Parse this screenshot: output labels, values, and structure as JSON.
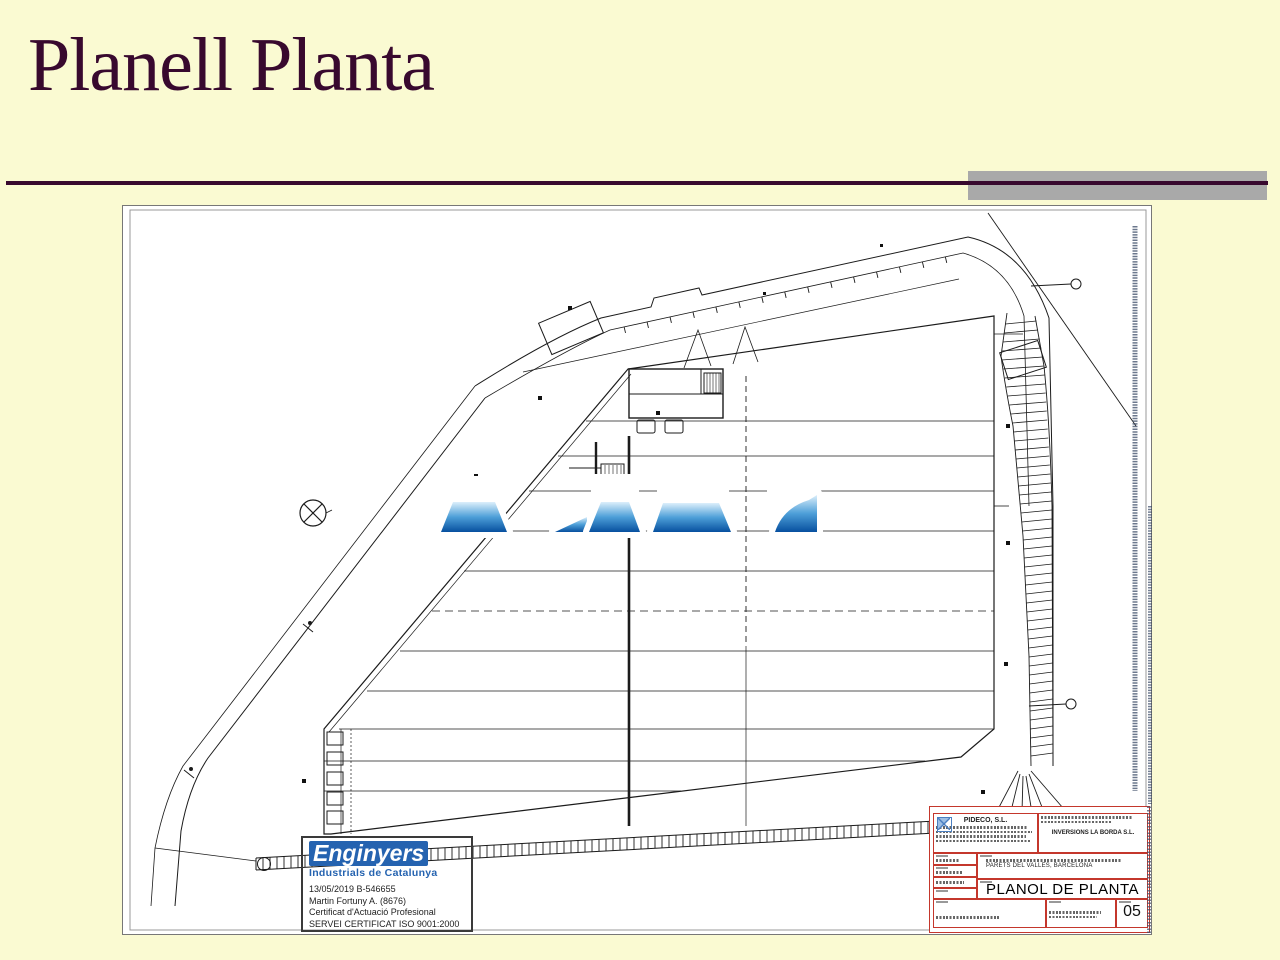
{
  "slide": {
    "title": "Planell Planta"
  },
  "colors": {
    "background": "#FAFAD2",
    "title_text": "#38092E",
    "divider": "#38092E",
    "accent_bar": "#A9A9A9",
    "stamp_blue": "#2563B0",
    "title_block_red": "#C4372C",
    "watermark_blue_dark": "#07509F",
    "watermark_blue_light": "#DCEFFB"
  },
  "plan": {
    "stamp": {
      "org": "Enginyers",
      "org_sub": "Industrials de Catalunya",
      "lines": [
        "13/05/2019   B-546655",
        "Martin Fortuny A.   (8676)",
        "Certificat d'Actuació Profesional",
        "SERVEI CERTIFICAT ISO 9001:2000"
      ]
    },
    "title_block": {
      "company": "PIDECO, S.L.",
      "client": "INVERSIONS LA BORDA S.L.",
      "location": "PARETS DEL VALLES, BARCELONA",
      "drawing_title": "PLANOL DE PLANTA",
      "sheet_number": "05"
    }
  }
}
